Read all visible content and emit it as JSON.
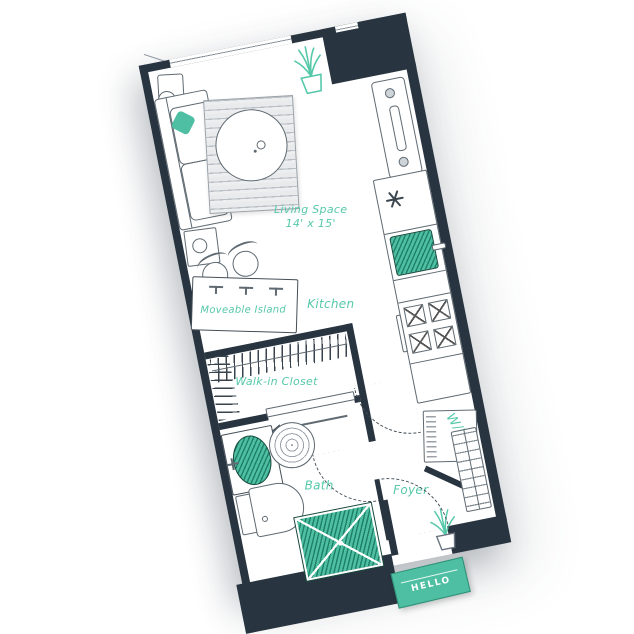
{
  "floorplan": {
    "living": {
      "label": "Living Space",
      "size": "14' x 15'"
    },
    "kitchen": {
      "label": "Kitchen"
    },
    "island": {
      "label": "Moveable Island"
    },
    "closet": {
      "label": "Walk-in Closet"
    },
    "bath": {
      "label": "Bath"
    },
    "foyer": {
      "label": "Foyer"
    },
    "washer_dryer": {
      "label": "W/D"
    },
    "doormat": {
      "label": "HELLO"
    },
    "colors": {
      "accent_teal": "#56c8aa",
      "wall_dark": "#283440"
    }
  }
}
